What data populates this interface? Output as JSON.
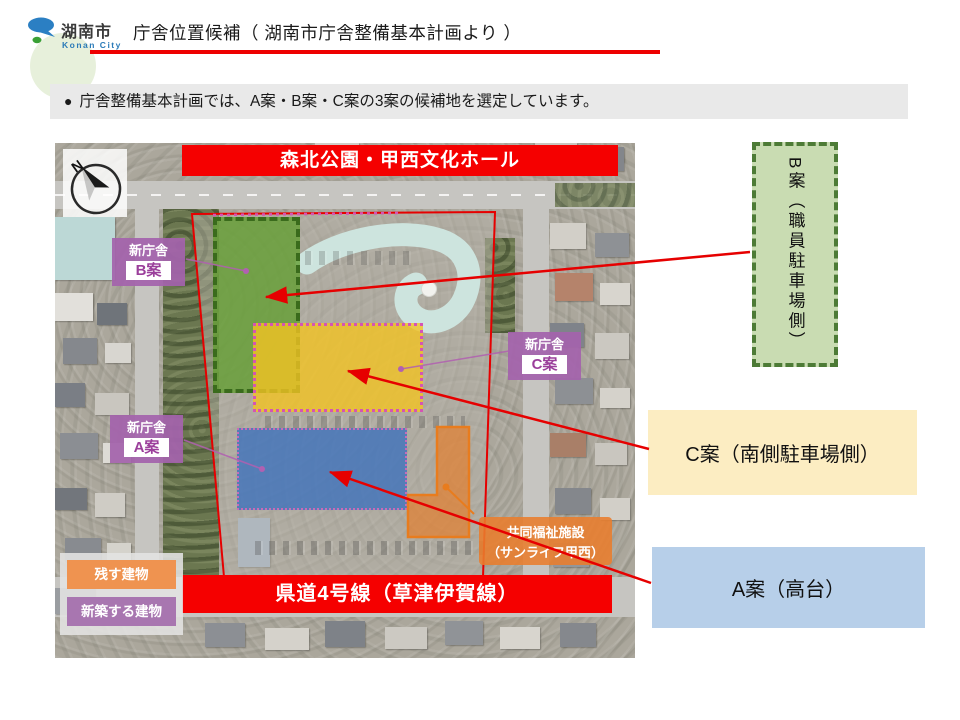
{
  "header": {
    "logo": {
      "name_ja": "湖南市",
      "name_en": "Konan City"
    },
    "title": "庁舎位置候補（ 湖南市庁舎整備基本計画より ）"
  },
  "lead": {
    "bullet": "●",
    "text": "庁舎整備基本計画では、A案・B案・C案の3案の候補地を選定しています。"
  },
  "map": {
    "compass": "N",
    "top_banner": "森北公園・甲西文化ホール",
    "bottom_banner": "県道4号線（草津伊賀線）",
    "labels": {
      "b": {
        "line1": "新庁舎",
        "line2": "B案"
      },
      "c": {
        "line1": "新庁舎",
        "line2": "C案"
      },
      "a": {
        "line1": "新庁舎",
        "line2": "A案"
      }
    },
    "facility": {
      "line1": "共同福祉施設",
      "line2": "（サンライフ甲西）"
    },
    "legend": [
      {
        "label": "残す建物",
        "color": "#ef9350"
      },
      {
        "label": "新築する建物",
        "color": "#a876b0"
      }
    ]
  },
  "callouts": {
    "b": "B案（職員駐車場側）",
    "c": "C案（南側駐車場側）",
    "a": "A案（高台）"
  },
  "colors": {
    "banner_red": "#f50000",
    "underline_red": "#ee0000",
    "arrow_red": "#e60000",
    "zone_b_green": "#61a02f",
    "zone_c_yellow": "#f3c323",
    "zone_a_blue": "#3e72bc",
    "site_label_purple": "#a463ac",
    "facility_orange": "#e97d2c",
    "callout_b_bg": "#c9dcb2",
    "callout_c_bg": "#fcedc2",
    "callout_a_bg": "#b7cfe9"
  }
}
